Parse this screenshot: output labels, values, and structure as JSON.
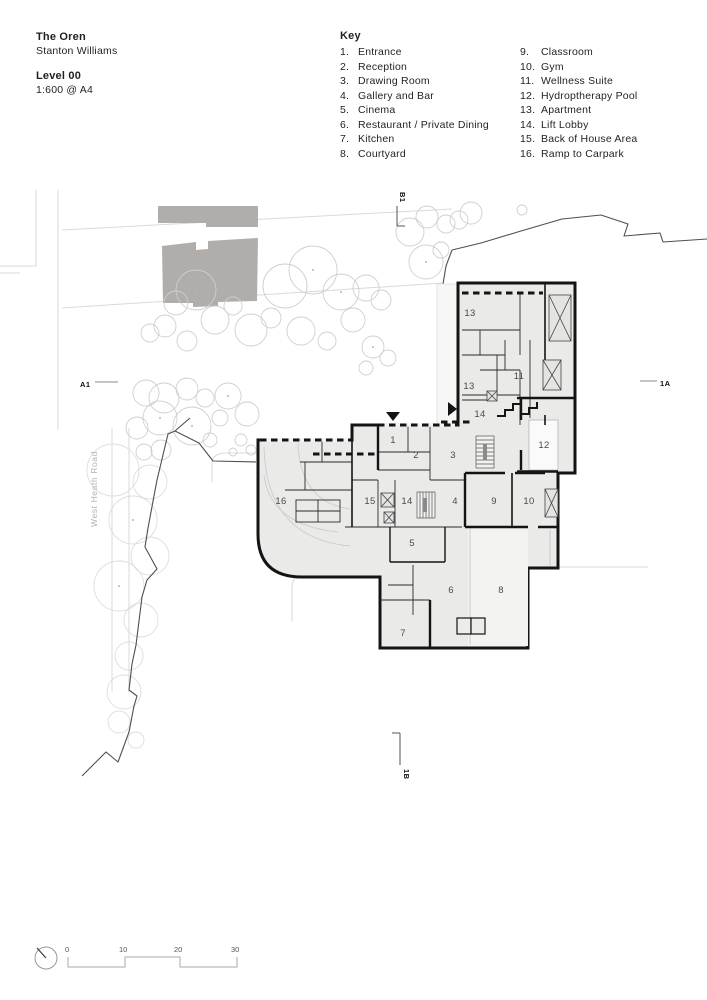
{
  "title_block": {
    "project": "The Oren",
    "architect": "Stanton Williams",
    "level": "Level 00",
    "scale": "1:600 @ A4"
  },
  "key": {
    "title": "Key",
    "col1": [
      {
        "num": "1.",
        "label": "Entrance"
      },
      {
        "num": "2.",
        "label": "Reception"
      },
      {
        "num": "3.",
        "label": "Drawing Room"
      },
      {
        "num": "4.",
        "label": "Gallery and Bar"
      },
      {
        "num": "5.",
        "label": "Cinema"
      },
      {
        "num": "6.",
        "label": "Restaurant / Private Dining"
      },
      {
        "num": "7.",
        "label": "Kitchen"
      },
      {
        "num": "8.",
        "label": "Courtyard"
      }
    ],
    "col2": [
      {
        "num": "9.",
        "label": "Classroom"
      },
      {
        "num": "10.",
        "label": "Gym"
      },
      {
        "num": "11.",
        "label": "Wellness Suite"
      },
      {
        "num": "12.",
        "label": "Hydroptherapy Pool"
      },
      {
        "num": "13.",
        "label": "Apartment"
      },
      {
        "num": "14.",
        "label": "Lift Lobby"
      },
      {
        "num": "15.",
        "label": "Back of House Area"
      },
      {
        "num": "16.",
        "label": "Ramp to Carpark"
      }
    ]
  },
  "plan": {
    "road_label": "West Heath Road",
    "section_markers": {
      "left": "A1",
      "right": "1A",
      "top": "B1",
      "bottom": "1B"
    },
    "room_labels": [
      "13",
      "13",
      "11",
      "14",
      "12",
      "1",
      "2",
      "3",
      "4",
      "9",
      "10",
      "15",
      "14",
      "5",
      "6",
      "7",
      "8",
      "16"
    ]
  },
  "scale_bar": {
    "labels": [
      "0",
      "10",
      "20",
      "30"
    ]
  },
  "colors": {
    "context_building": "#b0adab",
    "wall": "#141414",
    "floor": "#eaeae9",
    "courtyard": "#f3f3f2",
    "tree_outline": "#cfcfcf",
    "site_boundary": "#4f4f4f",
    "path_line": "#d9d9d9",
    "room_label": "#4a4a4a"
  }
}
